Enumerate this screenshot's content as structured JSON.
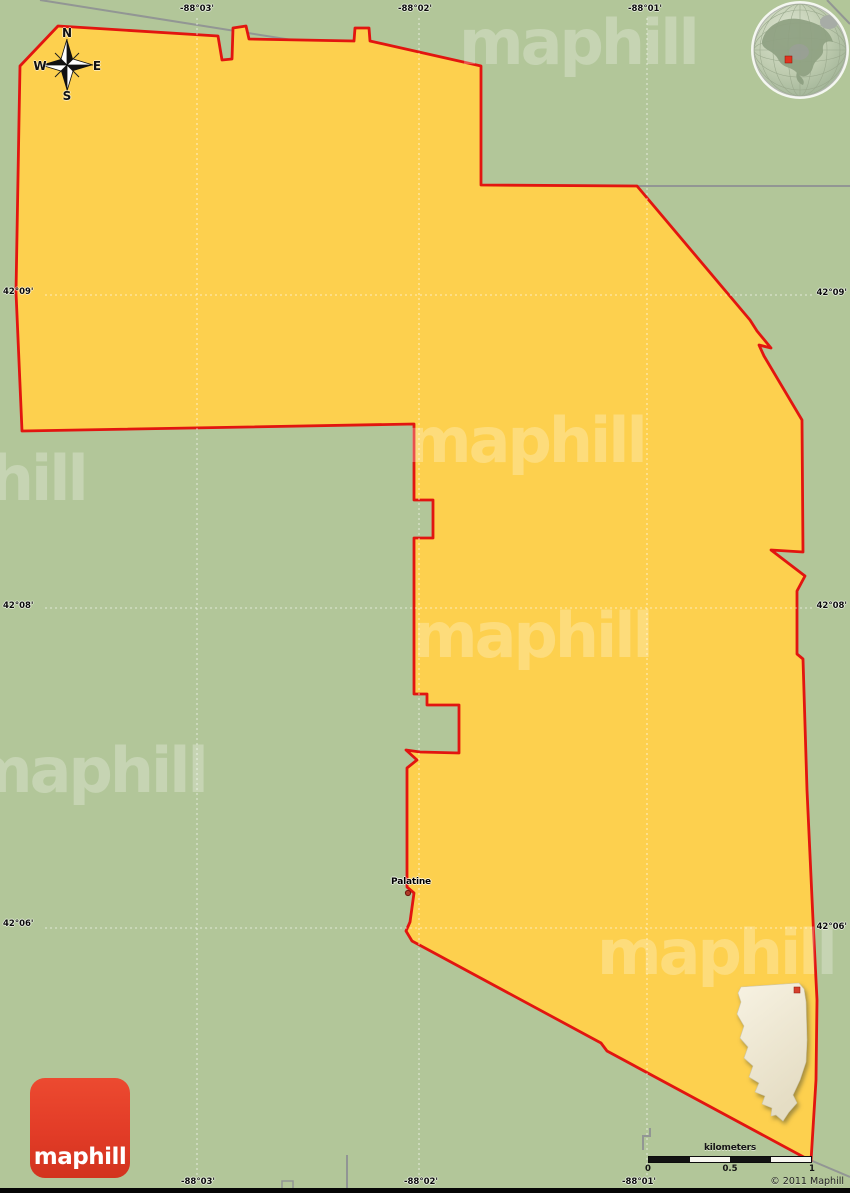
{
  "map": {
    "place_label": "Palatine",
    "watermark_text": "maphill",
    "copyright": "© 2011 Maphill"
  },
  "compass": {
    "n": "N",
    "e": "E",
    "s": "S",
    "w": "W"
  },
  "grid": {
    "top": [
      "-88°03'",
      "-88°02'",
      "-88°01'"
    ],
    "bottom": [
      "-88°03'",
      "-88°02'",
      "-88°01'"
    ],
    "left": [
      "42°09'",
      "42°08'",
      "42°06'"
    ],
    "right": [
      "42°09'",
      "42°08'",
      "42°06'"
    ]
  },
  "scale_bar": {
    "unit": "kilometers",
    "ticks": [
      "0",
      "0.5",
      "1"
    ]
  },
  "logo": {
    "text": "maphill"
  },
  "colors": {
    "background_green": "#b2c699",
    "area_fill_yellow": "#fdd04e",
    "area_border_red": "#e21510",
    "boundary_gray": "#8e9094",
    "logo_red": "#e6402c",
    "inset_fill": "#f2ecd9",
    "marker_red": "#d6402c"
  }
}
